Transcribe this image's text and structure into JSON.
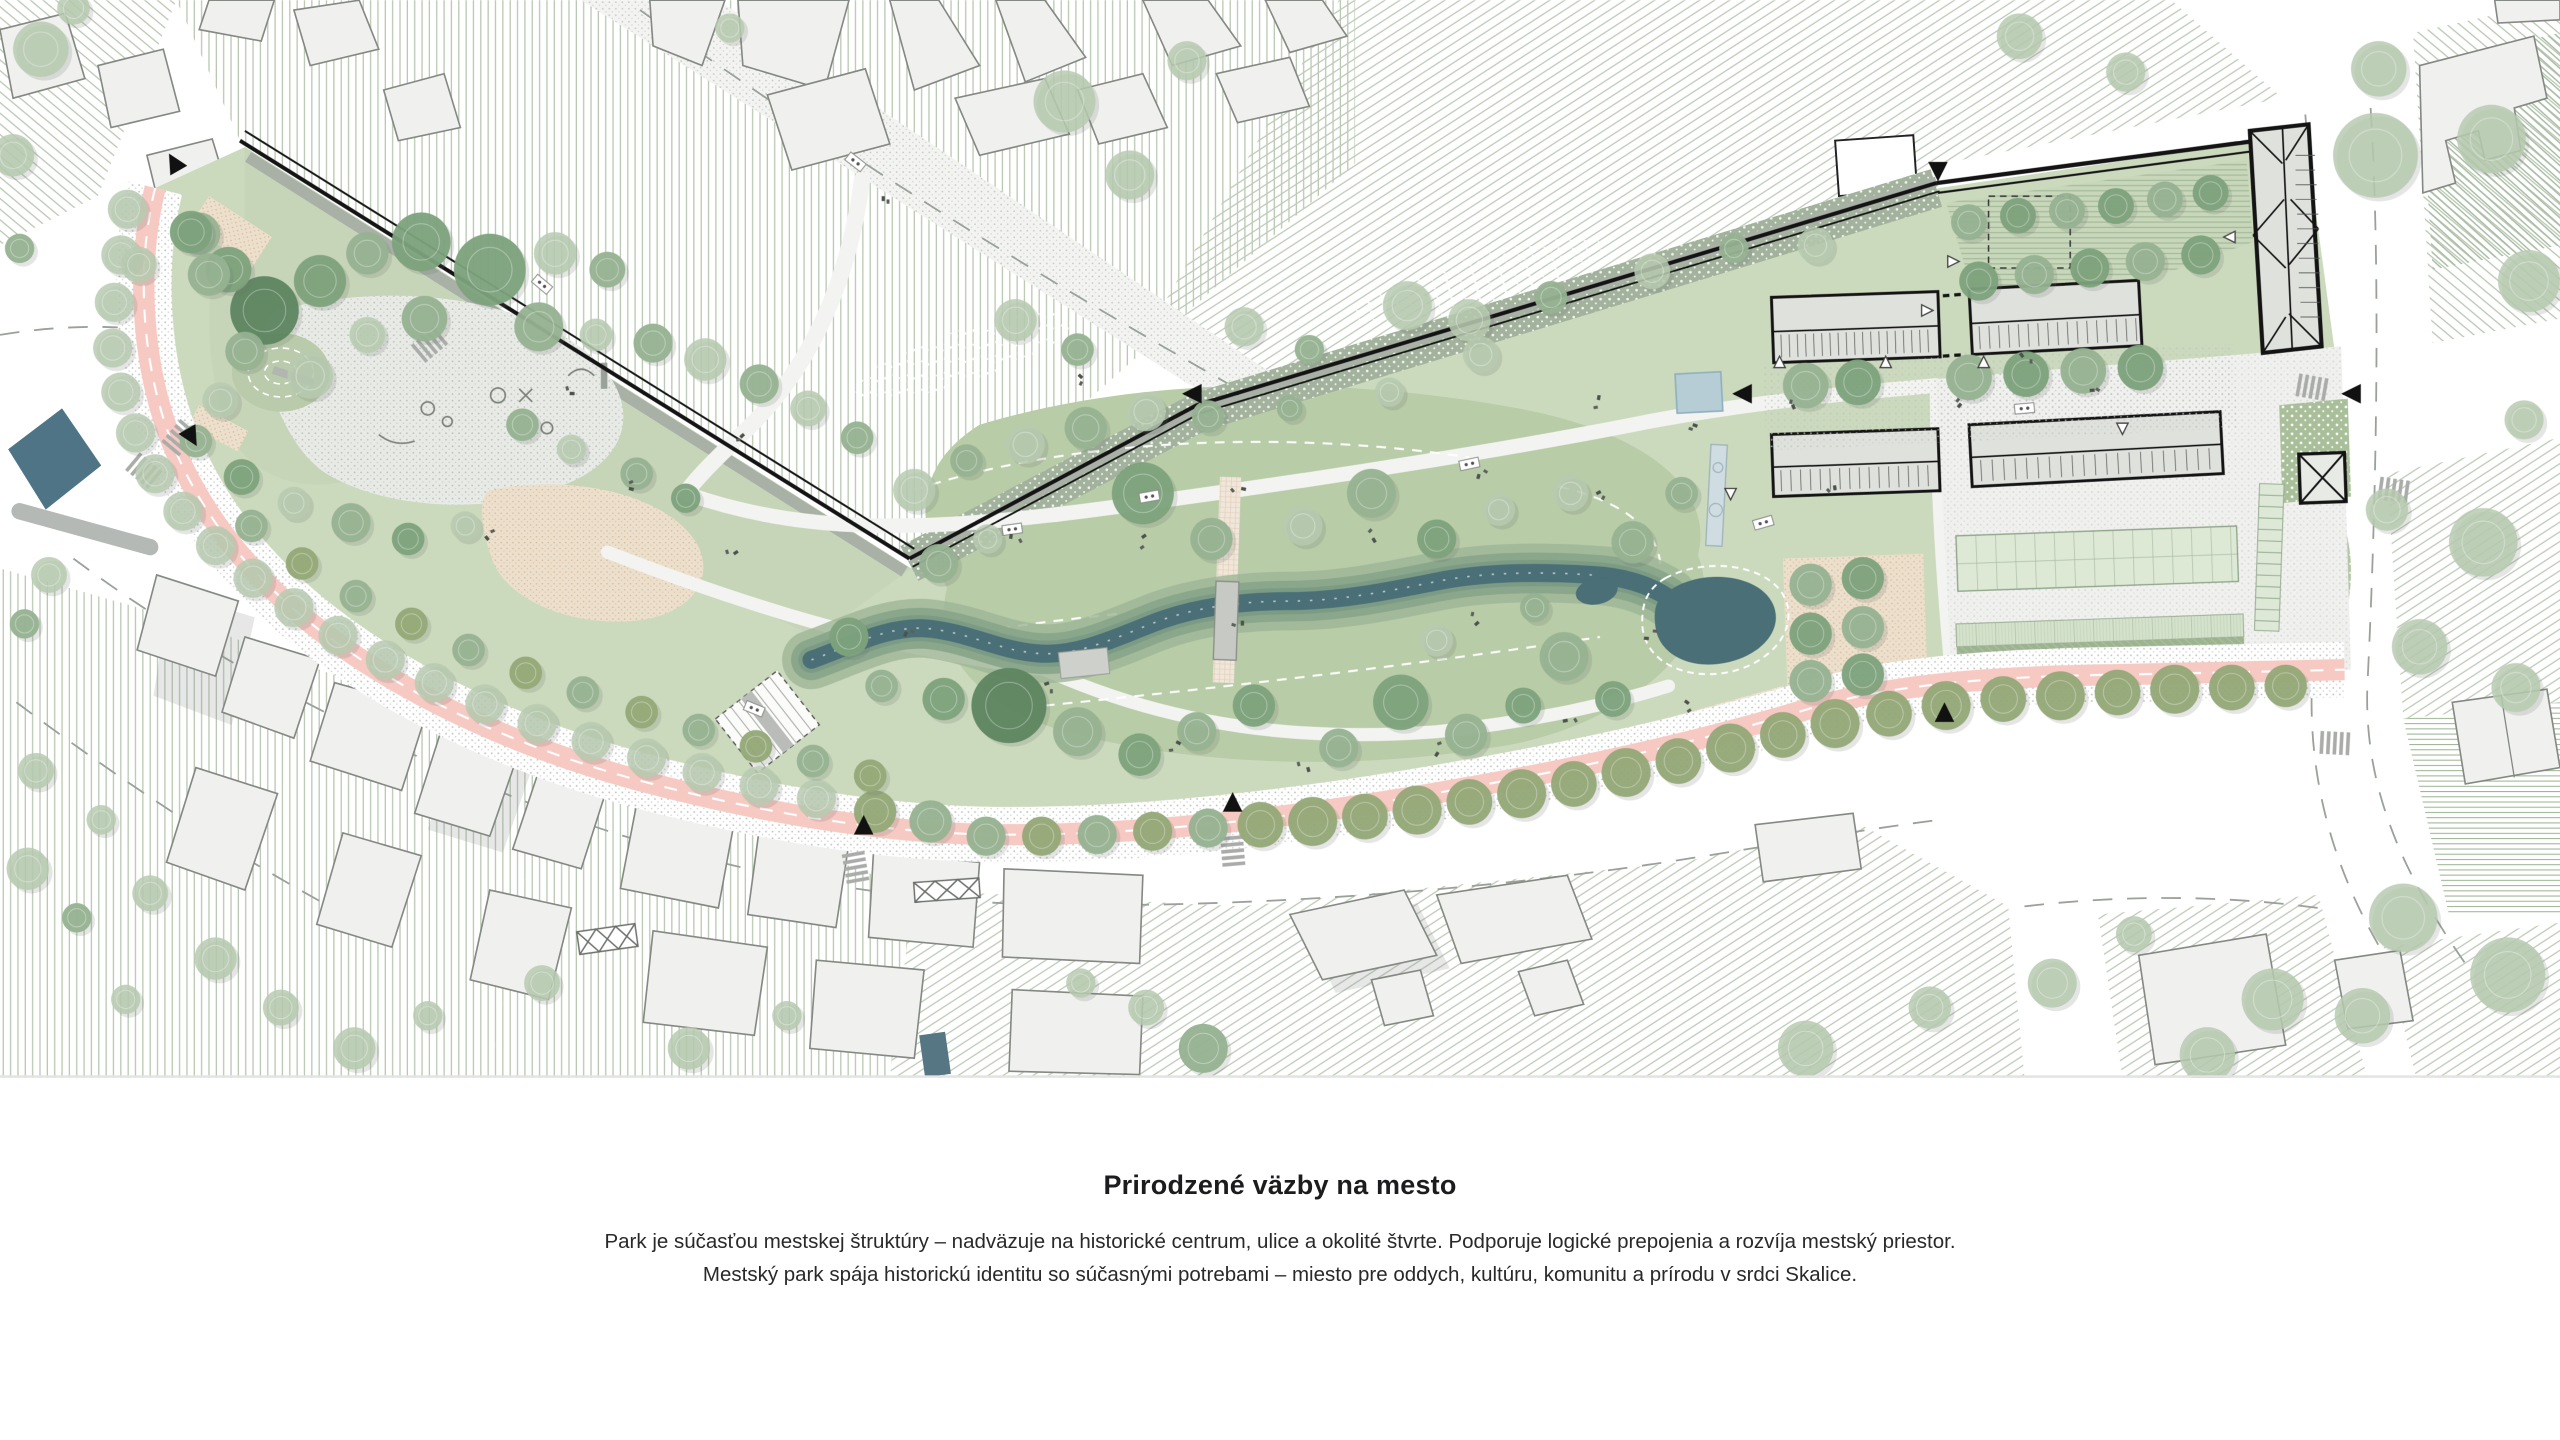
{
  "caption": {
    "title": "Prirodzené väzby na mesto",
    "line1": "Park je súčasťou mestskej štruktúry – nadväzuje na historické centrum, ulice a okolité štvrte. Podporuje logické prepojenia a rozvíja mestský priestor.",
    "line2": "Mestský park spája historickú identitu so súčasnými potrebami – miesto pre oddych, kultúru, komunitu a prírodu v srdci Skalice."
  },
  "palette": {
    "page_bg": "#ffffff",
    "text_color": "#1c1c1e",
    "lawn": "#cbd9bd",
    "lawn_light": "#c6d4b8",
    "meadow": "#b8cca8",
    "band_green": "#a3b29c",
    "band_gray": "#a9b0a6",
    "hatch_line": "#b9c8b2",
    "water": "#4a6f77",
    "pool_blue": "#b7cdd6",
    "promenade_pink": "#f6c9c2",
    "paving": "#f0f1ee",
    "stipple_dot": "#bfc4bf",
    "sand": "#ebdfcd",
    "brick": "#dcc2ac",
    "wall_black": "#141414",
    "building_fill": "#f0f1ef",
    "building_outline": "#858983",
    "teal_building": "#4e7486",
    "tree_dark": "#5d8560",
    "tree_medium": "#7da27c",
    "tree_sage": "#96b291",
    "tree_pale": "#b7cab0",
    "tree_olive": "#93a877"
  }
}
